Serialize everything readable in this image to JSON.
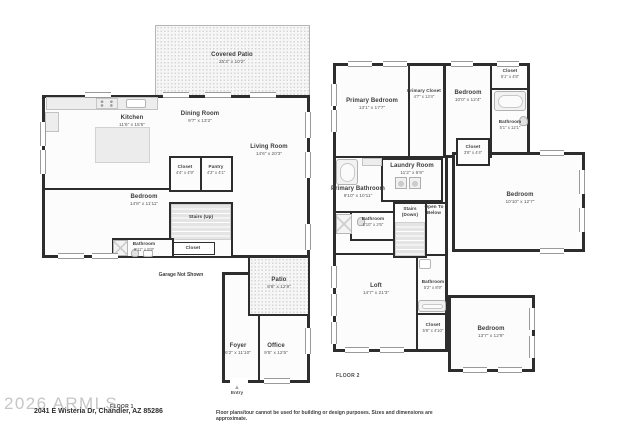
{
  "page": {
    "watermark": "2026 ARMLS",
    "address": "2041 E Wisteria Dr, Chandler, AZ 85286",
    "floor1_label": "FLOOR 1",
    "floor2_label": "FLOOR 2",
    "entry_label": "Entry",
    "garage_note": "Garage Not Shown",
    "disclaimer": "Floor plans/tour cannot be used for building or design purposes. Sizes and dimensions are approximate."
  },
  "icons": {
    "entry_arrow": "▲"
  },
  "colors": {
    "wall": "#2d2d2d",
    "window_frame": "#9a9a9a",
    "label": "#3c3c3c",
    "watermark": "#c6c6c6",
    "fixture": "#ededed"
  },
  "floor1": {
    "rooms": [
      {
        "name": "Covered Patio",
        "dims": "25'3\" x 10'2\""
      },
      {
        "name": "Kitchen",
        "dims": "11'6\" x 15'5\""
      },
      {
        "name": "Dining Room",
        "dims": "9'7\" x 13'2\""
      },
      {
        "name": "Living Room",
        "dims": "14'6\" x 20'3\""
      },
      {
        "name": "Closet",
        "dims": "4'4\" x 4'9\""
      },
      {
        "name": "Pantry",
        "dims": "4'3\" x 4'1\""
      },
      {
        "name": "Bedroom",
        "dims": "14'8\" x 11'11\""
      },
      {
        "name": "Stairs (Up)",
        "dims": ""
      },
      {
        "name": "Closet",
        "dims": ""
      },
      {
        "name": "Bathroom",
        "dims": "9'11\" x 5'9\""
      },
      {
        "name": "Patio",
        "dims": "9'8\" x 12'9\""
      },
      {
        "name": "Foyer",
        "dims": "6'2\" x 11'10\""
      },
      {
        "name": "Office",
        "dims": "9'5\" x 12'5\""
      }
    ]
  },
  "floor2": {
    "rooms": [
      {
        "name": "Primary Bedroom",
        "dims": "13'1\" x 17'7\""
      },
      {
        "name": "Primary Closet",
        "dims": "4'7\" x 13'4\""
      },
      {
        "name": "Bedroom",
        "dims": "10'0\" x 12'4\""
      },
      {
        "name": "Closet",
        "dims": "5'1\" x 4'8\""
      },
      {
        "name": "Bathroom",
        "dims": "5'1\" x 12'1\""
      },
      {
        "name": "Closet",
        "dims": "3'8\" x 4'4\""
      },
      {
        "name": "Laundry Room",
        "dims": "11'2\" x 6'9\""
      },
      {
        "name": "Primary Bathroom",
        "dims": "9'10\" x 10'11\""
      },
      {
        "name": "Bathroom",
        "dims": "5'10\" x 2'6\""
      },
      {
        "name": "Stairs (Down)",
        "dims": ""
      },
      {
        "name": "Open To Below",
        "dims": ""
      },
      {
        "name": "Bedroom",
        "dims": "10'10\" x 12'7\""
      },
      {
        "name": "Loft",
        "dims": "14'7\" x 21'3\""
      },
      {
        "name": "Bathroom",
        "dims": "5'2\" x 8'9\""
      },
      {
        "name": "Closet",
        "dims": "5'8\" x 4'10\""
      },
      {
        "name": "Bedroom",
        "dims": "13'7\" x 12'9\""
      }
    ]
  }
}
